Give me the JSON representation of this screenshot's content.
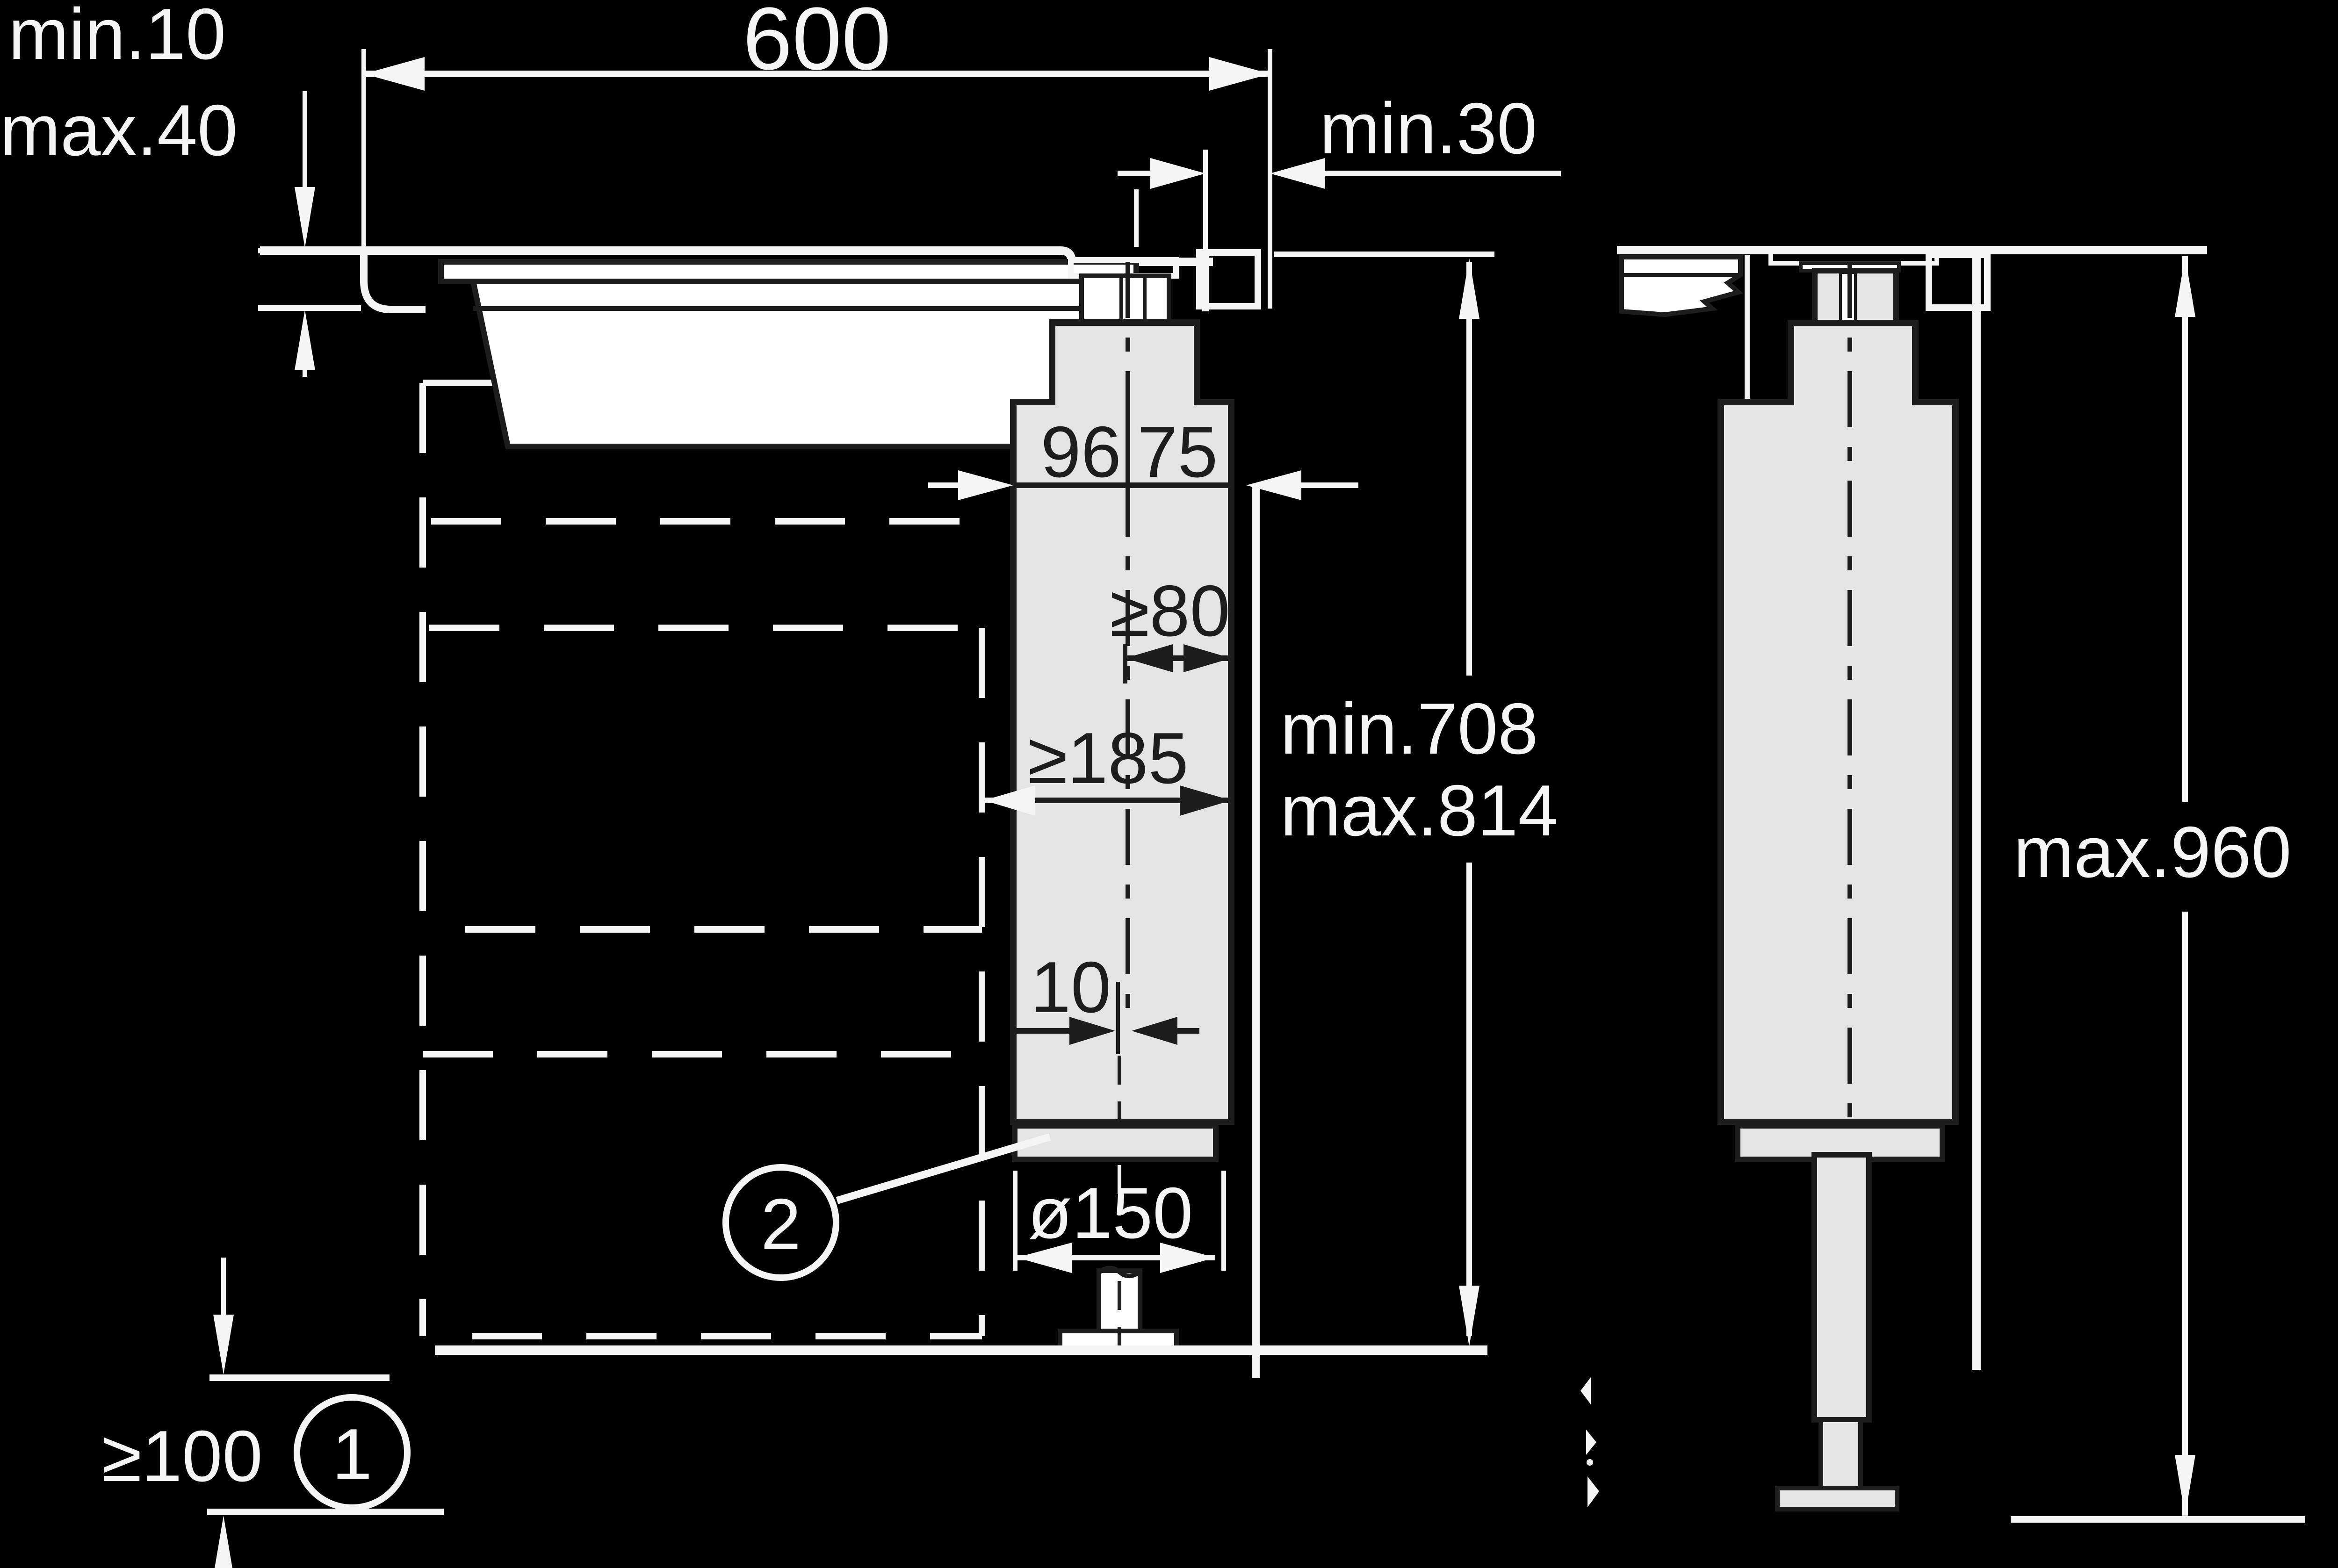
{
  "colors": {
    "background": "#000000",
    "line_light": "#f5f5f5",
    "line_dark": "#1d1d1d",
    "fill_gray": "#e4e4e4",
    "fill_white": "#ffffff"
  },
  "labels": {
    "recess_depth_min": "min.10",
    "recess_depth_max": "max.40",
    "worktop_cutout_width": "600",
    "side_clearance_min": "min.30",
    "duct_front_depth": "96",
    "duct_rear_depth": "75",
    "clearance_width_min": "≥80",
    "clearance_depth_min": "≥185",
    "install_height_min": "min.708",
    "install_height_max": "max.814",
    "centre_offset": "10",
    "exhaust_diameter": "ø150",
    "plinth_height_min": "≥100",
    "overall_height_max": "max.960",
    "callout_plinth": "1",
    "callout_duct": "2"
  }
}
